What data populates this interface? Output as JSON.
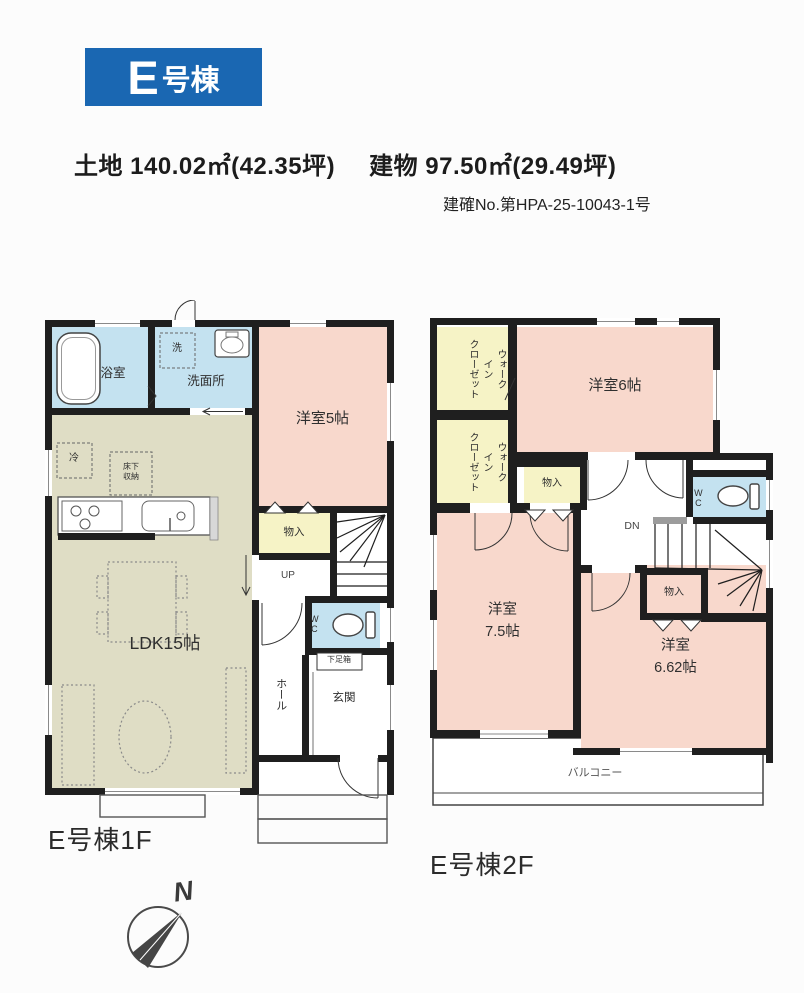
{
  "header": {
    "badge_letter": "E",
    "badge_suffix": "号棟",
    "land": "土地 140.02㎡(42.35坪)",
    "building": "建物 97.50㎡(29.49坪)",
    "permit_no": "建確No.第HPA-25-10043-1号"
  },
  "floor1": {
    "caption": "E号棟1F",
    "labels": {
      "bath": "浴室",
      "washroom": "洗面所",
      "laundry": "洗",
      "western5": "洋室5帖",
      "closet": "物入",
      "ldk": "LDK15帖",
      "fridge": "冷",
      "floor_storage": "床下\n収納",
      "stairs_up": "UP",
      "wc": "WC",
      "shoe_box": "下足箱",
      "hall": "ホール",
      "entrance": "玄関"
    }
  },
  "floor2": {
    "caption": "E号棟2F",
    "labels": {
      "wic_upper": "ウォーク\nイン\nクローゼット",
      "wic_lower": "ウォーク\nイン\nクローゼット",
      "western6": "洋室6帖",
      "closet_upper": "物入",
      "wc": "WC",
      "stairs_down": "DN",
      "closet_lower": "物入",
      "western75": "洋室\n7.5帖",
      "western662": "洋室\n6.62帖",
      "balcony": "バルコニー"
    }
  },
  "compass": {
    "north_label": "N"
  },
  "colors": {
    "page_bg": "#fcfcfc",
    "badge_blue": "#1a67b2",
    "room_pink": "#f8d8cc",
    "room_yellow": "#f6f3c6",
    "room_blue": "#c4e2f0",
    "room_olive": "#dfddc5",
    "wall_black": "#1f1f1f"
  }
}
